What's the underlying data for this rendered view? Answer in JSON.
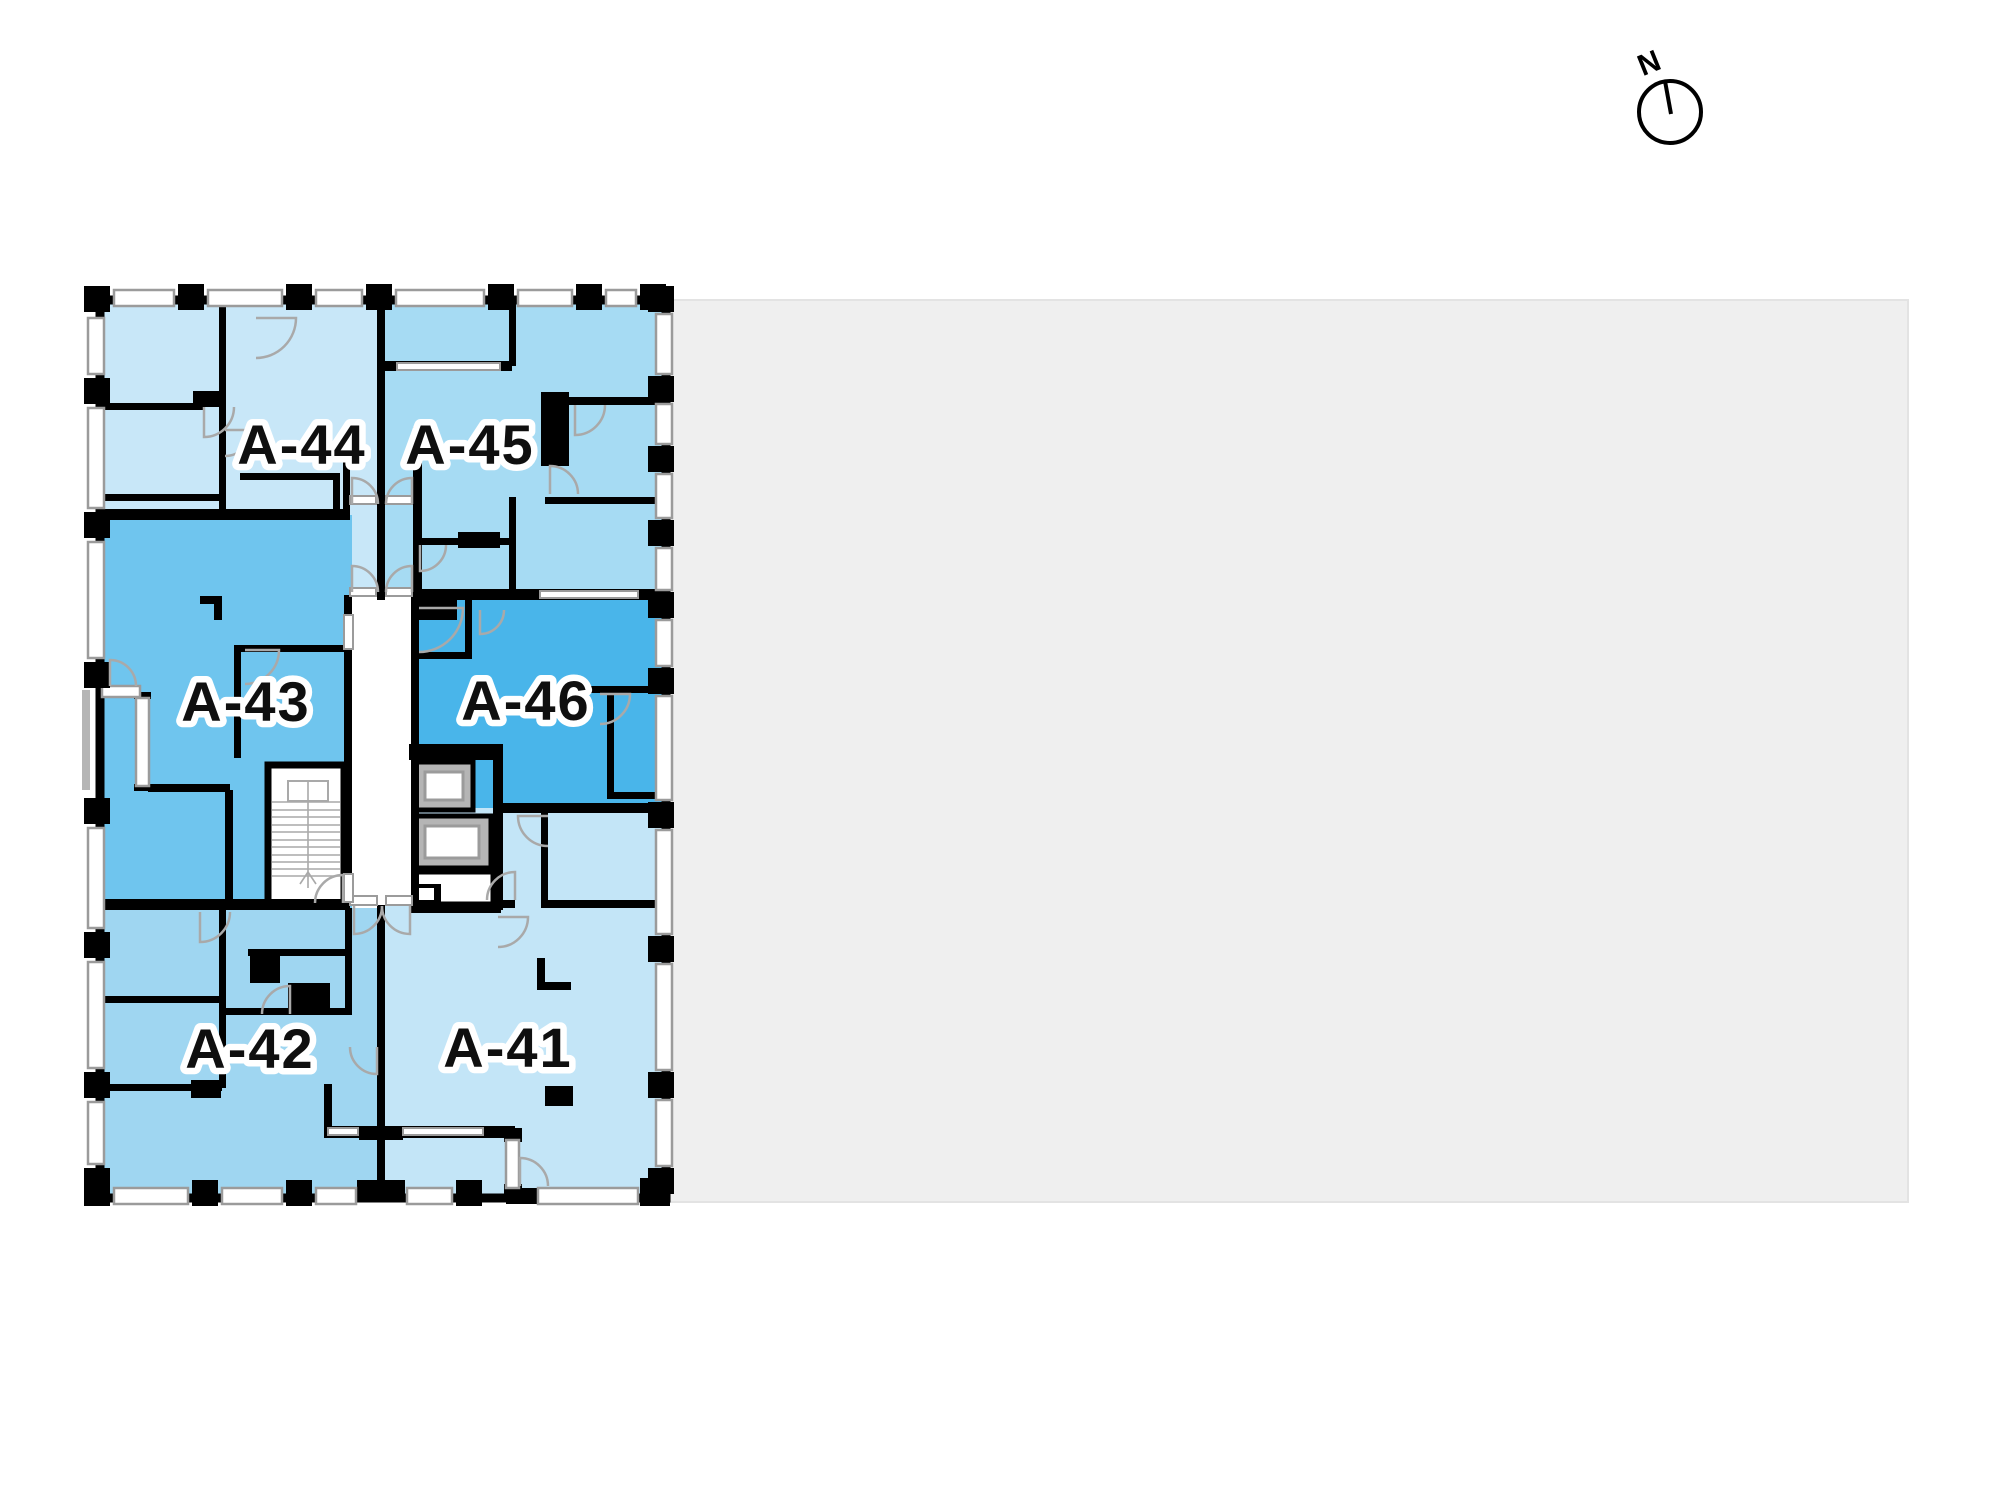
{
  "page": {
    "background_color": "#ffffff"
  },
  "site_area": {
    "fill": "#efefef"
  },
  "compass": {
    "label": "N"
  },
  "floor_plan": {
    "wall_color": "#000000",
    "window_fill": "#ffffff",
    "window_frame_color": "#9b9b9b",
    "door_arc_color": "#a9a9a9",
    "core_fill": "#ffffff",
    "elevator_fill": "#b5b5b5",
    "label_ink": "#0f0f0f",
    "label_halo": "#ffffff",
    "units": [
      {
        "id": "A-44",
        "label": "A-44",
        "color": "#c8e7f8"
      },
      {
        "id": "A-45",
        "label": "A-45",
        "color": "#a6dbf3"
      },
      {
        "id": "A-43",
        "label": "A-43",
        "color": "#6fc5ee"
      },
      {
        "id": "A-46",
        "label": "A-46",
        "color": "#49b5ea"
      },
      {
        "id": "A-42",
        "label": "A-42",
        "color": "#9fd6f1"
      },
      {
        "id": "A-41",
        "label": "A-41",
        "color": "#c3e5f7"
      }
    ]
  }
}
